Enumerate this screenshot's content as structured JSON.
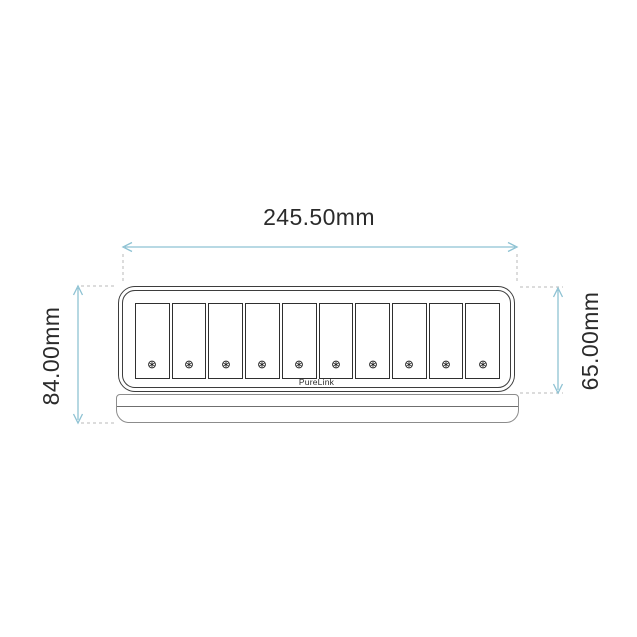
{
  "drawing": {
    "width_dimension": "245.50mm",
    "height_overall_dimension": "84.00mm",
    "height_body_dimension": "65.00mm",
    "device": {
      "brand": "PureLink",
      "slot_count": 10,
      "slot_fastener": "torx-screw-icon"
    },
    "colors": {
      "dimension_line": "#8ec2d3",
      "extension_line": "#b9b9b9",
      "device_outline": "#3d3d3d",
      "base_outline": "#8c8c8c",
      "label_text": "#2b2b2b"
    }
  }
}
